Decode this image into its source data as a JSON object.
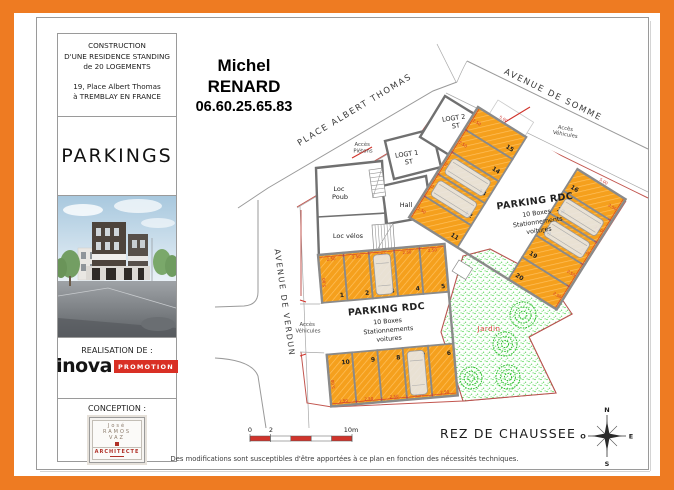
{
  "frame": {
    "color": "#ee7b22"
  },
  "sidebar": {
    "project": {
      "lines": [
        "CONSTRUCTION",
        "D'UNE RESIDENCE STANDING",
        "de 20 LOGEMENTS"
      ],
      "address": [
        "19, Place Albert Thomas",
        "à TREMBLAY EN FRANCE"
      ]
    },
    "doc_title": "PARKINGS",
    "realisation_label": "REALISATION DE :",
    "brand": {
      "name": "inova",
      "suffix": "PROMOTION",
      "color": "#d93025"
    },
    "conception_label": "CONCEPTION :",
    "architect": {
      "lines": [
        "José",
        "RAMOS",
        "VAZ"
      ],
      "title": "ARCHITECTE"
    }
  },
  "contact": {
    "first_name": "Michel",
    "last_name": "RENARD",
    "phone": "06.60.25.65.83"
  },
  "plan": {
    "streets": {
      "top": "PLACE ALBERT THOMAS",
      "right": "AVENUE DE SOMME",
      "left": "AVENUE DE VERDUN"
    },
    "rooms": {
      "logt2": [
        "LOGT 2",
        "ST"
      ],
      "logt1": [
        "LOGT 1",
        "ST"
      ],
      "loc_poub": [
        "Loc",
        "Poub"
      ],
      "hall": "Hall",
      "loc_velos": "Loc vélos"
    },
    "access": {
      "pedestrian": [
        "Accès",
        "Piétons"
      ],
      "vehicle_top": [
        "Accès",
        "Véhicules"
      ],
      "vehicle_left": [
        "Accès",
        "Véhicules"
      ]
    },
    "garden_label": "Jardin",
    "dimensions": {
      "box_width": "2.50",
      "box_length": "5.00"
    },
    "parking_blocks": [
      {
        "title": "PARKING RDC",
        "lines": [
          "10 Boxes",
          "Stationnements",
          "voitures"
        ],
        "groups": [
          [
            "1",
            "2",
            "3",
            "4",
            "5"
          ],
          [
            "10",
            "9",
            "8",
            "7",
            "6"
          ]
        ]
      },
      {
        "title": "PARKING RDC",
        "lines": [
          "10 Boxes",
          "Stationnements",
          "voitures"
        ],
        "groups": [
          [
            "15",
            "14",
            "13",
            "12",
            "11"
          ],
          [
            "16",
            "17",
            "18",
            "19",
            "20"
          ]
        ]
      }
    ]
  },
  "footer": {
    "scale_ticks": [
      "0",
      "2",
      "10m"
    ],
    "level": "REZ DE CHAUSSEE",
    "compass": {
      "n": "N",
      "e": "E",
      "s": "S",
      "o": "O"
    },
    "disclaimer": "Des modifications sont susceptibles d'être apportées à ce plan en fonction des nécessités techniques."
  }
}
